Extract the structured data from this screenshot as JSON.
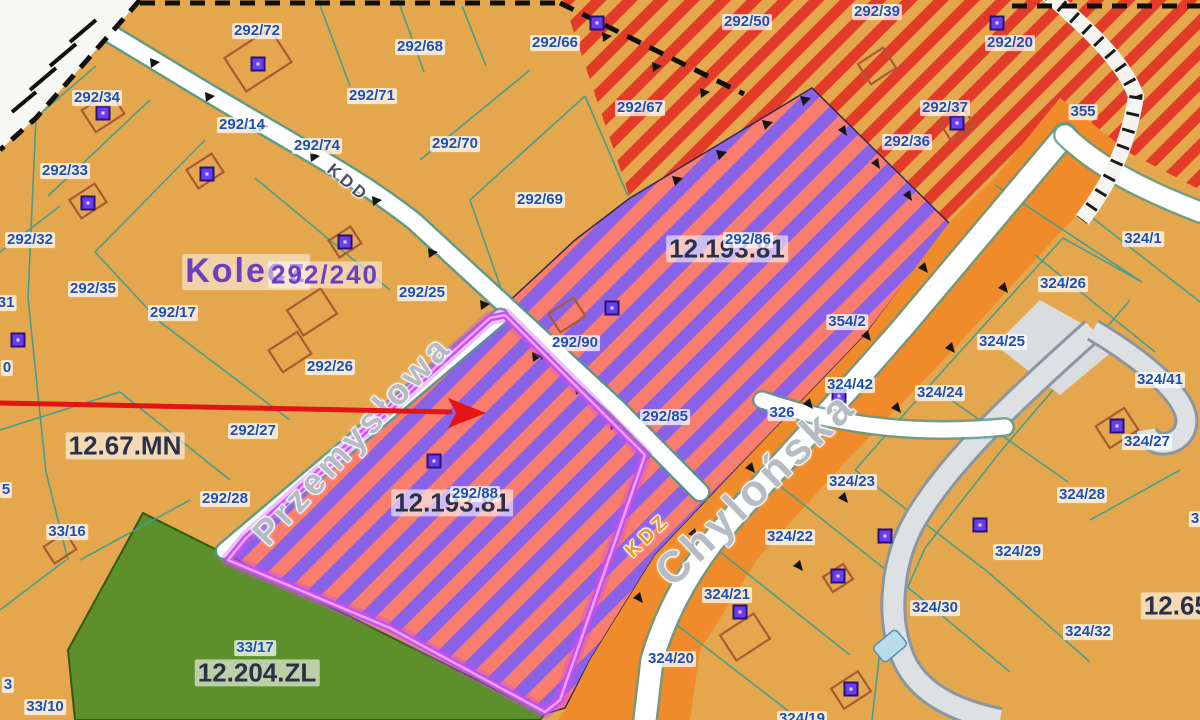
{
  "map": {
    "title": "Zoning plan map view (MPZP) – Chylonia / Przemysłowa area",
    "colors": {
      "background_parcels": "#e5a74e",
      "red_stripe_zone": "#e23c28",
      "purple_zone": "#8a62e8",
      "purple_zone_stripe": "#f87d6e",
      "green_zone": "#5d8f2b",
      "road_corridor_orange": "#ef8b2a",
      "selection_outline": "#c94df0",
      "parcel_label_text": "#1b4fae",
      "zone_label_text": "#2a3048",
      "place_label_text": "#6a3fc0",
      "street_label_text": "#b6bcc4",
      "annotation_arrow": "#e21414",
      "parcel_line_teal": "#3d9f90"
    },
    "labels": {
      "parcels": [
        {
          "t": "292/72",
          "x": 257,
          "y": 31
        },
        {
          "t": "292/34",
          "x": 97,
          "y": 98
        },
        {
          "t": "292/14",
          "x": 242,
          "y": 125
        },
        {
          "t": "292/74",
          "x": 317,
          "y": 146
        },
        {
          "t": "292/33",
          "x": 65,
          "y": 171
        },
        {
          "t": "292/71",
          "x": 372,
          "y": 96
        },
        {
          "t": "292/68",
          "x": 420,
          "y": 47
        },
        {
          "t": "292/66",
          "x": 555,
          "y": 43
        },
        {
          "t": "292/50",
          "x": 747,
          "y": 22
        },
        {
          "t": "292/67",
          "x": 640,
          "y": 108
        },
        {
          "t": "292/70",
          "x": 455,
          "y": 144
        },
        {
          "t": "292/69",
          "x": 540,
          "y": 200
        },
        {
          "t": "292/39",
          "x": 877,
          "y": 12
        },
        {
          "t": "292/20",
          "x": 1010,
          "y": 43
        },
        {
          "t": "292/37",
          "x": 945,
          "y": 108
        },
        {
          "t": "292/36",
          "x": 907,
          "y": 142
        },
        {
          "t": "355",
          "x": 1083,
          "y": 112
        },
        {
          "t": "292/32",
          "x": 30,
          "y": 240
        },
        {
          "t": "292/35",
          "x": 93,
          "y": 289
        },
        {
          "t": "292/17",
          "x": 173,
          "y": 313
        },
        {
          "t": "/31",
          "x": 4,
          "y": 303
        },
        {
          "t": "0",
          "x": 7,
          "y": 368
        },
        {
          "t": "5",
          "x": 6,
          "y": 490
        },
        {
          "t": "292/25",
          "x": 422,
          "y": 293
        },
        {
          "t": "292/26",
          "x": 330,
          "y": 367
        },
        {
          "t": "292/90",
          "x": 575,
          "y": 343
        },
        {
          "t": "292/27",
          "x": 253,
          "y": 431
        },
        {
          "t": "292/28",
          "x": 225,
          "y": 499
        },
        {
          "t": "292/86",
          "x": 748,
          "y": 240
        },
        {
          "t": "292/88",
          "x": 475,
          "y": 494
        },
        {
          "t": "292/85",
          "x": 665,
          "y": 417
        },
        {
          "t": "326",
          "x": 782,
          "y": 413
        },
        {
          "t": "354/2",
          "x": 847,
          "y": 322
        },
        {
          "t": "324/1",
          "x": 1143,
          "y": 239
        },
        {
          "t": "324/26",
          "x": 1063,
          "y": 284
        },
        {
          "t": "324/25",
          "x": 1002,
          "y": 342
        },
        {
          "t": "324/42",
          "x": 850,
          "y": 385
        },
        {
          "t": "324/24",
          "x": 940,
          "y": 393
        },
        {
          "t": "324/41",
          "x": 1160,
          "y": 380
        },
        {
          "t": "324/23",
          "x": 852,
          "y": 482
        },
        {
          "t": "324/22",
          "x": 790,
          "y": 537
        },
        {
          "t": "324/21",
          "x": 727,
          "y": 595
        },
        {
          "t": "324/20",
          "x": 671,
          "y": 659
        },
        {
          "t": "324/19",
          "x": 802,
          "y": 719
        },
        {
          "t": "324/27",
          "x": 1147,
          "y": 442
        },
        {
          "t": "324/28",
          "x": 1082,
          "y": 495
        },
        {
          "t": "324/29",
          "x": 1018,
          "y": 552
        },
        {
          "t": "324/30",
          "x": 935,
          "y": 608
        },
        {
          "t": "324/32",
          "x": 1088,
          "y": 632
        },
        {
          "t": "3",
          "x": 1195,
          "y": 519
        },
        {
          "t": "33/16",
          "x": 67,
          "y": 532
        },
        {
          "t": "33/17",
          "x": 255,
          "y": 648
        },
        {
          "t": "33/10",
          "x": 45,
          "y": 707
        },
        {
          "t": "3",
          "x": 8,
          "y": 685
        }
      ],
      "zones": [
        {
          "t": "12.67.MN",
          "x": 125,
          "y": 446
        },
        {
          "t": "12.193.81",
          "x": 727,
          "y": 249
        },
        {
          "t": "12.193.81",
          "x": 452,
          "y": 503
        },
        {
          "t": "12.204.ZL",
          "x": 257,
          "y": 673
        },
        {
          "t": "12.65.",
          "x": 1180,
          "y": 606
        }
      ],
      "places": [
        {
          "t": "Kolecz",
          "x": 246,
          "y": 272,
          "s": 34
        },
        {
          "t": "292/240",
          "x": 325,
          "y": 275,
          "s": 26
        }
      ],
      "streets": [
        {
          "t": "Przemysłowa",
          "x": 352,
          "y": 440,
          "s": 36,
          "r": -47
        },
        {
          "t": "Chylońska",
          "x": 756,
          "y": 489,
          "s": 44,
          "r": -44
        },
        {
          "t": "KDD",
          "x": 348,
          "y": 183,
          "s": 17,
          "r": 40,
          "c": "#4a4f66"
        },
        {
          "t": "KDZ",
          "x": 648,
          "y": 536,
          "s": 20,
          "r": -44,
          "c": "#e89a28"
        }
      ]
    },
    "annotation": {
      "arrow_from_x": 0,
      "arrow_from_y": 403,
      "arrow_tip_x": 486,
      "arrow_tip_y": 413
    }
  }
}
